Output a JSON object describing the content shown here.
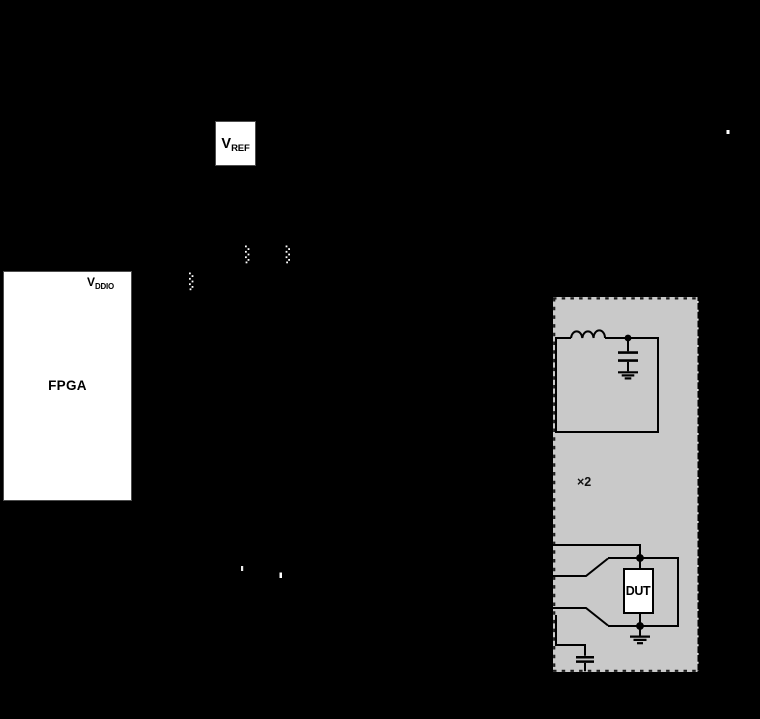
{
  "panel": {
    "multiplier_label": "×2"
  },
  "boxes": {
    "vref": {
      "main": "V",
      "sub": "REF"
    },
    "vddio": {
      "main": "V",
      "sub": "DDIO"
    },
    "fpga": {
      "label": "FPGA"
    },
    "dut": {
      "label": "DUT"
    }
  },
  "colors": {
    "background": "#000000",
    "panel_fill": "#c9c9c9",
    "panel_border_dash": "#1a1a1a",
    "panel_border_light_dash": "#e0e0e0",
    "line": "#000000",
    "box_fill": "#ffffff",
    "box_border": "#4d4d4d",
    "text": "#000000",
    "artifact_white": "#ffffff"
  }
}
